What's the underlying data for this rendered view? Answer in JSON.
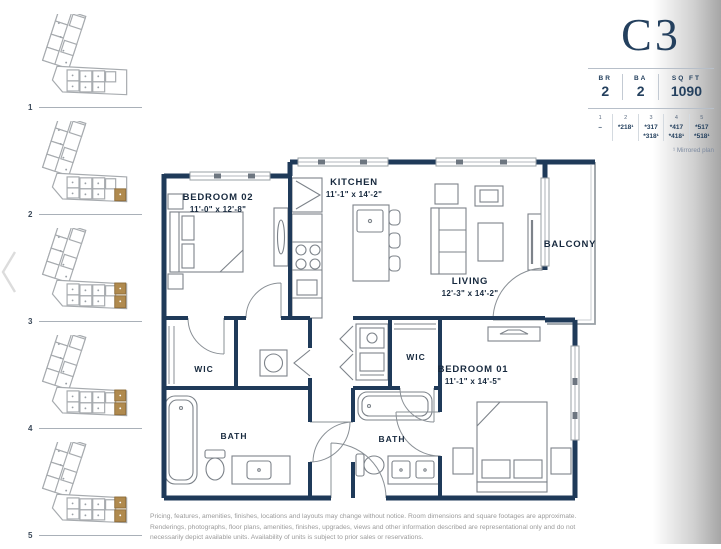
{
  "page": {
    "title": "C3",
    "disclaimer": "Pricing, features, amenities, finishes, locations and layouts may change without notice. Room dimensions and square footages are approximate. Renderings, photographs, floor plans, amenities, finishes, upgrades, views and other information described are representational only and do not necessarily depict available units. Availability of units is subject to prior sales or reservations."
  },
  "stats": {
    "br_label": "BR",
    "br_value": "2",
    "ba_label": "BA",
    "ba_value": "2",
    "sqft_label": "SQ FT",
    "sqft_value": "1090"
  },
  "unit_grid": {
    "note": "¹ Mirrored plan",
    "cols": [
      {
        "num": "1",
        "u1": "–",
        "u2": ""
      },
      {
        "num": "2",
        "u1": "*218¹",
        "u2": ""
      },
      {
        "num": "3",
        "u1": "*317",
        "u2": "*318¹"
      },
      {
        "num": "4",
        "u1": "*417",
        "u2": "*418¹"
      },
      {
        "num": "5",
        "u1": "*517",
        "u2": "*518¹"
      }
    ]
  },
  "sidebar": {
    "floors": [
      {
        "label": "1"
      },
      {
        "label": "2"
      },
      {
        "label": "3"
      },
      {
        "label": "4"
      },
      {
        "label": "5"
      }
    ]
  },
  "rooms": {
    "bedroom02": {
      "name": "BEDROOM 02",
      "dims": "11'-0\" x 12'-8\""
    },
    "kitchen": {
      "name": "KITCHEN",
      "dims": "11'-1\" x 14'-2\""
    },
    "living": {
      "name": "LIVING",
      "dims": "12'-3\" x 14'-2\""
    },
    "balcony": {
      "name": "BALCONY"
    },
    "bedroom01": {
      "name": "BEDROOM 01",
      "dims": "11'-1\" x 14'-5\""
    },
    "wic_left": {
      "name": "WIC"
    },
    "wic_right": {
      "name": "WIC"
    },
    "bath_left": {
      "name": "BATH"
    },
    "bath_right": {
      "name": "BATH"
    }
  },
  "colors": {
    "navy": "#1f3a59",
    "gold": "#b08a4e",
    "grey": "#9aa0a6"
  }
}
